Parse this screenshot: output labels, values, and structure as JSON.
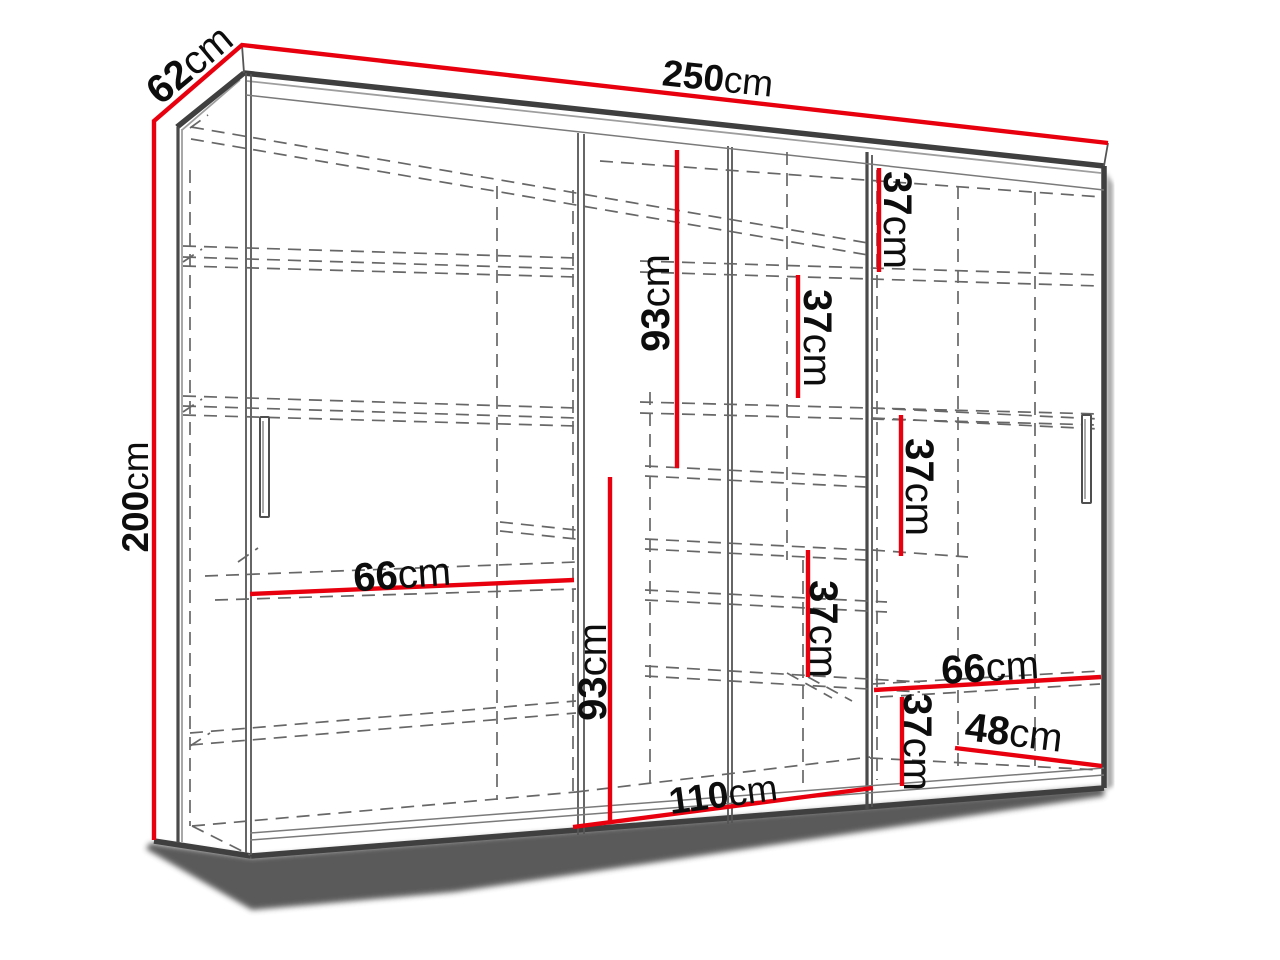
{
  "diagram": {
    "subject": "wardrobe-technical-drawing",
    "background": "#ffffff",
    "line_colors": {
      "dimension_red": "#e8000f",
      "structure_gray": "#3f3f3f",
      "dashed_gray": "#676767",
      "label_text": "#0d0d0d"
    },
    "dims": {
      "w250": {
        "num": "250",
        "unit": "cm",
        "measure": "overall-width"
      },
      "d62": {
        "num": "62",
        "unit": "cm",
        "measure": "overall-depth"
      },
      "h200": {
        "num": "200",
        "unit": "cm",
        "measure": "overall-height"
      },
      "g93a": {
        "num": "93",
        "unit": "cm",
        "measure": "upper-compartment-height"
      },
      "g93b": {
        "num": "93",
        "unit": "cm",
        "measure": "lower-compartment-height"
      },
      "g37a": {
        "num": "37",
        "unit": "cm",
        "measure": "shelf-spacing-top-right"
      },
      "g37b": {
        "num": "37",
        "unit": "cm",
        "measure": "shelf-spacing-upper-middle"
      },
      "g37c": {
        "num": "37",
        "unit": "cm",
        "measure": "shelf-spacing-right-middle"
      },
      "g37d": {
        "num": "37",
        "unit": "cm",
        "measure": "shelf-spacing-lower-middle"
      },
      "g37e": {
        "num": "37",
        "unit": "cm",
        "measure": "shelf-spacing-bottom-right"
      },
      "w66l": {
        "num": "66",
        "unit": "cm",
        "measure": "left-shelf-width"
      },
      "w66r": {
        "num": "66",
        "unit": "cm",
        "measure": "right-shelf-width"
      },
      "w110": {
        "num": "110",
        "unit": "cm",
        "measure": "middle-section-width"
      },
      "w48": {
        "num": "48",
        "unit": "cm",
        "measure": "right-compartment-width"
      }
    }
  }
}
